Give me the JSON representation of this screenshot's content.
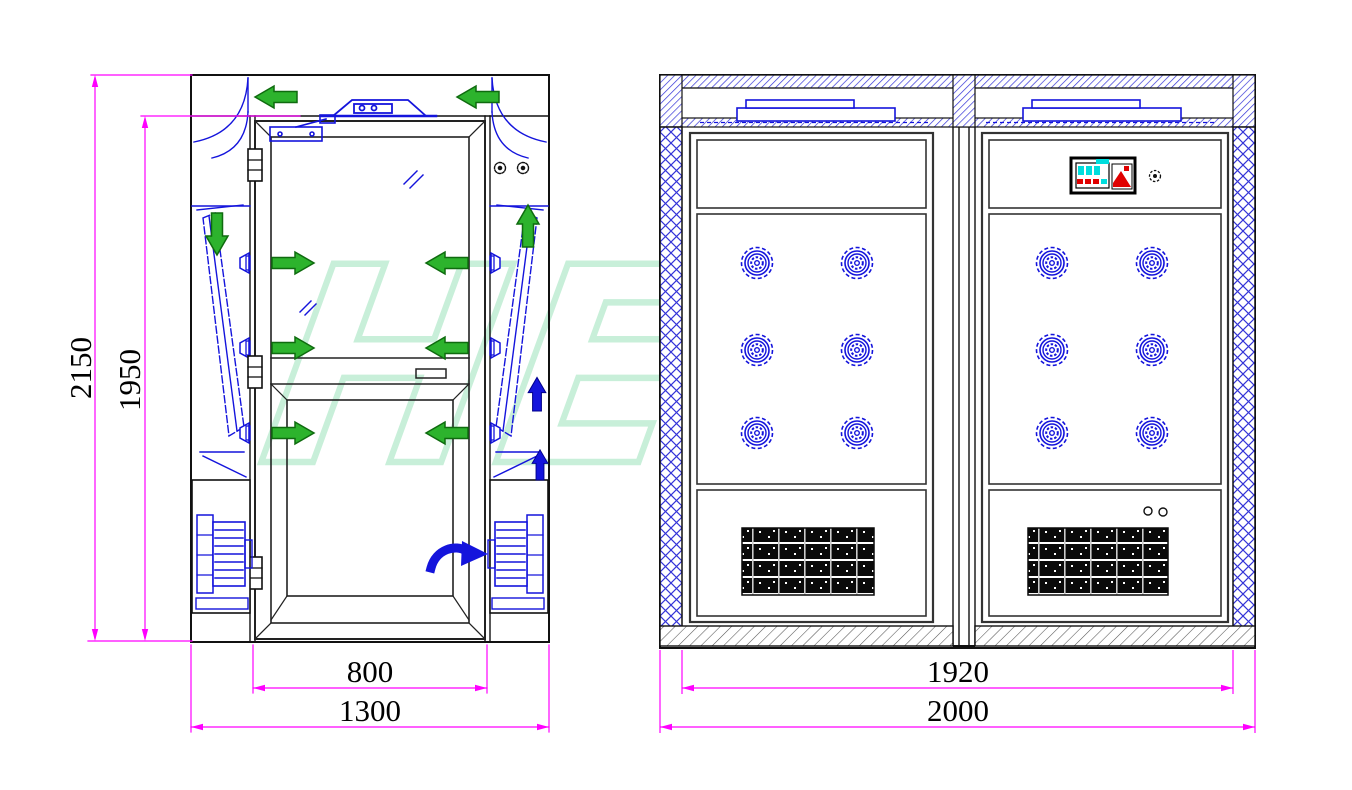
{
  "drawing": {
    "type": "cad-technical-drawing",
    "subject": "air shower clean-room unit, two elevation views",
    "watermark": {
      "text": "HEFIL",
      "color": "#c8efd9"
    },
    "front_view": {
      "name": "front-elevation-with-door",
      "dims": {
        "overall_height": "2150",
        "door_height": "1950",
        "door_width": "800",
        "overall_width": "1300"
      },
      "features": [
        "swing door with glass panel",
        "green airflow arrows",
        "blue return-air arrows",
        "corner blower fans",
        "angled HEPA filters",
        "door closer",
        "interlock buttons"
      ]
    },
    "side_view": {
      "name": "internal-section-nozzle-walls",
      "dims": {
        "inner_width": "1920",
        "overall_width": "2000"
      },
      "nozzles": {
        "panels": 2,
        "rows": 3,
        "cols": 2,
        "total": 12
      },
      "features": [
        "top fan plenum",
        "control panel",
        "return air grilles",
        "cross-hatched walls",
        "hatched floor"
      ]
    },
    "colors": {
      "cad_line": "#1a1a1a",
      "component_blue": "#1414dc",
      "airflow_green": "#2db32d",
      "dimension_magenta": "#ff00ff",
      "watermark_green": "#c8efd9",
      "control_cyan": "#00dede",
      "control_red": "#e00000"
    }
  }
}
